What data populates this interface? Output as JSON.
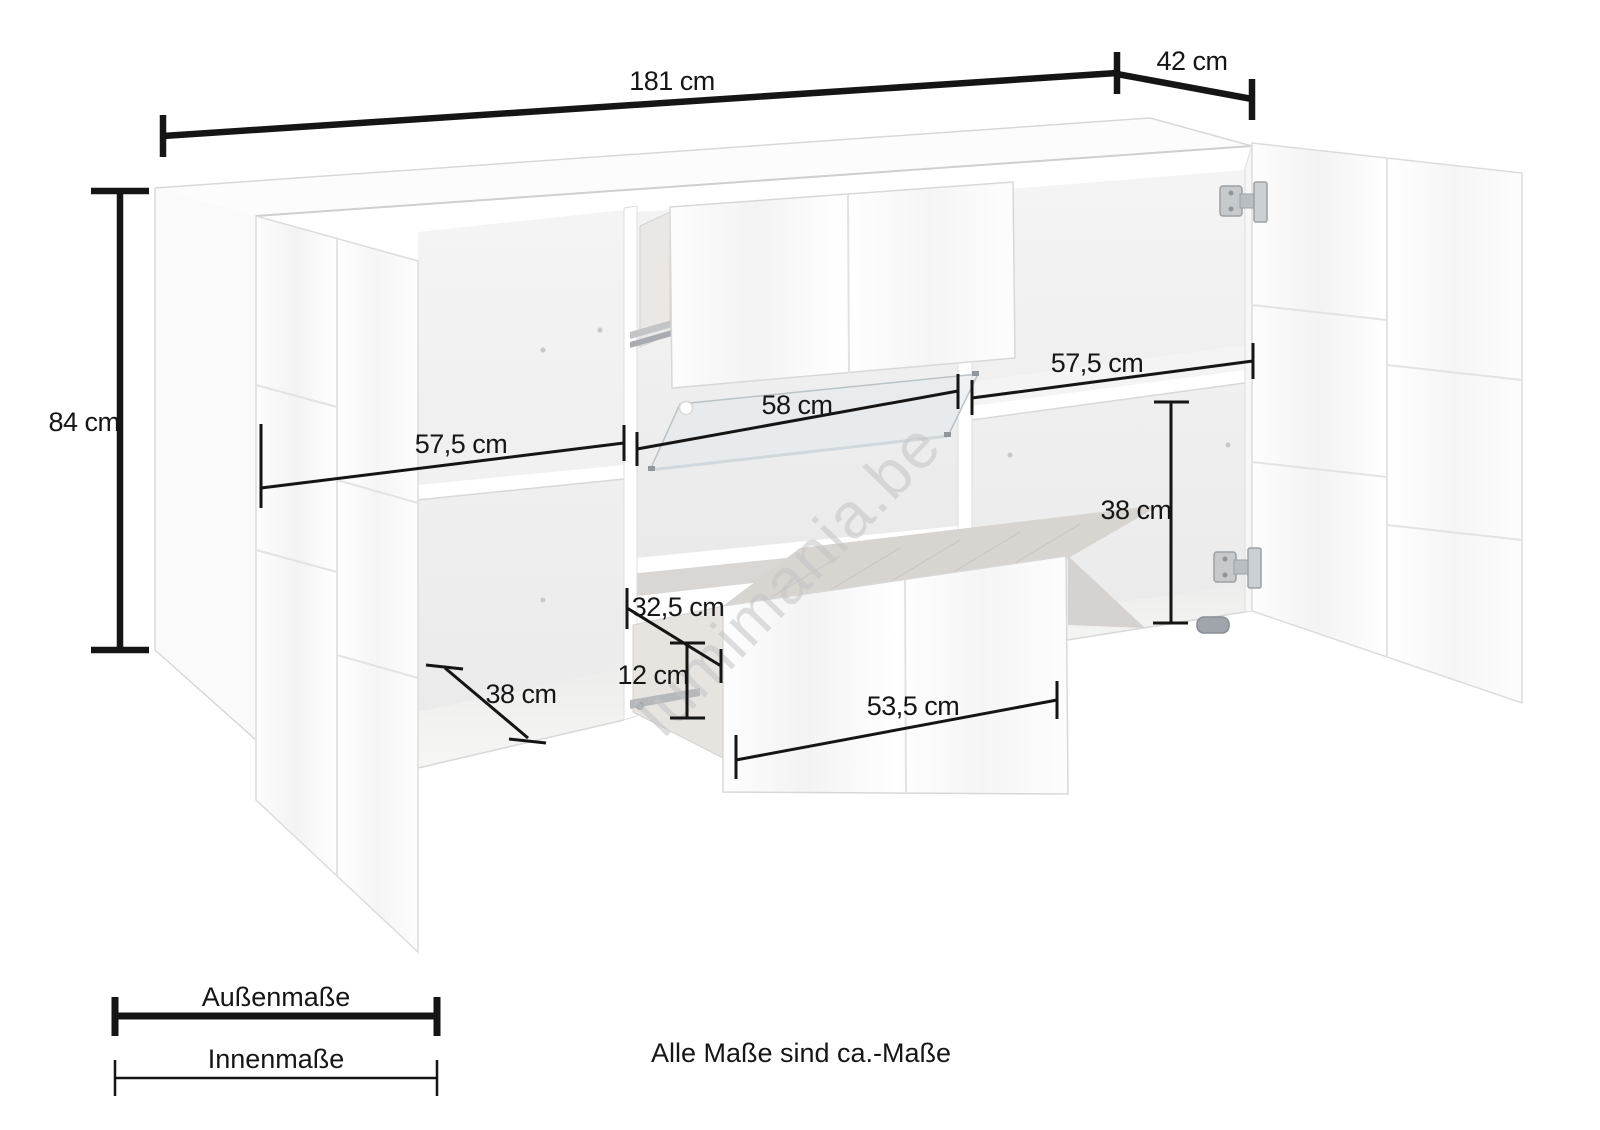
{
  "diagram": {
    "type": "furniture-dimension-diagram",
    "product": "sideboard",
    "background": "#ffffff",
    "dimension_line_color": "#151515",
    "watermark": "lumimania.be",
    "dims": {
      "outer_width": "181 cm",
      "outer_depth": "42 cm",
      "outer_height": "84 cm",
      "inner_left_width": "57,5 cm",
      "inner_mid_width": "58 cm",
      "inner_right_width": "57,5 cm",
      "inner_right_height": "38 cm",
      "inner_left_depth": "38 cm",
      "drawer_depth": "32,5 cm",
      "drawer_inner_height": "12 cm",
      "drawer_front_width": "53,5 cm"
    },
    "legend": {
      "outer": "Außenmaße",
      "inner": "Innenmaße",
      "note": "Alle Maße sind ca.-Maße"
    }
  }
}
